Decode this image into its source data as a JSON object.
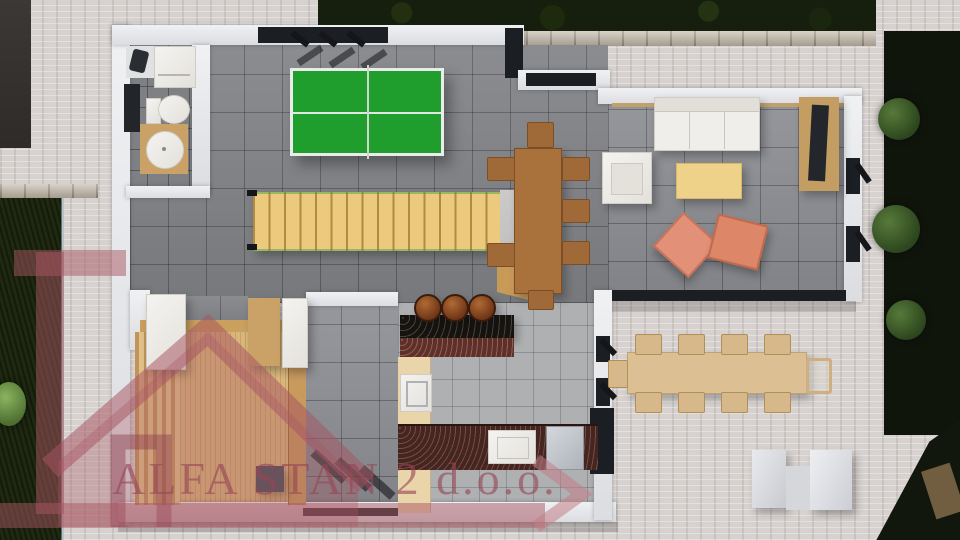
{
  "meta": {
    "type": "3d-floor-plan-render",
    "view": "top-down interior render of a house ground floor with terrace and garden"
  },
  "watermark": {
    "text": "ALFA STAN 2 d.o.o.",
    "logo": "house-outline-logo",
    "color": "#a75562"
  },
  "scene": {
    "rooms": [
      "bathroom",
      "game room",
      "living room",
      "dining area",
      "kitchen",
      "sauna",
      "stair hall",
      "outdoor terrace",
      "garden"
    ],
    "furniture": [
      "ping-pong table",
      "wooden staircase",
      "dining table with seven chairs",
      "white sofa",
      "white armchair",
      "yellow coffee table",
      "two coral poufs",
      "tv sideboard with tv",
      "kitchen bar with three stools",
      "kitchen sink",
      "stove",
      "toilet",
      "bathroom vanity sink",
      "washing machine",
      "sauna bench",
      "outdoor dining table with ten chairs",
      "white outdoor bench"
    ]
  },
  "palette": {
    "paver": "#d7d2cf",
    "paver_terrace": "#ded7d3",
    "grass_dark": "#1b240f",
    "hedge": "#161e0e",
    "tree": "#2c451d",
    "stone_wall": "#c8beae",
    "tile_gray": "#85868a",
    "tile_light": "#afb0b2",
    "wood_light": "#e3c088",
    "wood_stairs": "#ecca7d",
    "wood_table": "#a9713c",
    "wood_outdoor": "#dcbf92",
    "green_table": "#1f9e2e",
    "sofa_white": "#efeeea",
    "coffee_yellow": "#eed289",
    "pouf_coral": "#e29077",
    "counter_black": "#17130f",
    "counter_red": "#5e3029",
    "cabinet_cream": "#ead5ab",
    "watermark": "#a75562"
  }
}
